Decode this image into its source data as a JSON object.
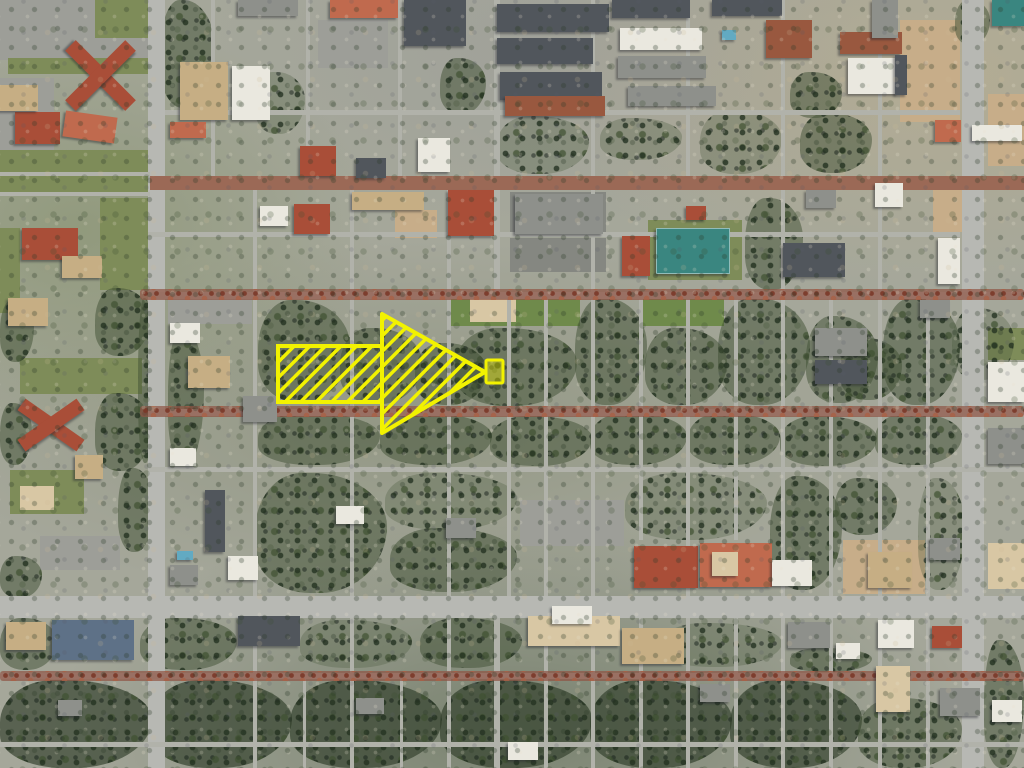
{
  "scene": {
    "palette": {
      "lawn": "#7e8c59",
      "lawn_bright": "#6f8a4b",
      "dirt": "#c7ad89",
      "dirt_light": "#d8c7a4",
      "parking": "#9d9e98",
      "parking_dark": "#858781",
      "road": "#b1b2aa",
      "road_major": "#b7b8b3",
      "brick_road": "#9b6956",
      "roof_red": "#a94e38",
      "roof_red_light": "#c06a4e",
      "roof_tan": "#c6ae84",
      "roof_white": "#eae8df",
      "roof_gray": "#8e908b",
      "roof_slate": "#51565c",
      "roof_blue": "#5e7187",
      "roof_brick": "#99583f",
      "court_teal": "#3a8680",
      "pool_blue": "#62aac2",
      "annotation_yellow": "#f2f200"
    },
    "areas": [
      [
        0,
        0,
        148,
        60,
        "parking"
      ],
      [
        95,
        0,
        53,
        38,
        "lawn"
      ],
      [
        8,
        58,
        140,
        16,
        "lawn"
      ],
      [
        0,
        78,
        54,
        76,
        "parking"
      ],
      [
        318,
        20,
        70,
        48,
        "parking"
      ],
      [
        0,
        150,
        150,
        44,
        "lawn"
      ],
      [
        100,
        198,
        48,
        92,
        "lawn"
      ],
      [
        0,
        228,
        20,
        85,
        "lawn"
      ],
      [
        20,
        358,
        122,
        36,
        "lawn"
      ],
      [
        10,
        470,
        74,
        44,
        "lawn"
      ],
      [
        20,
        486,
        34,
        24,
        "dirt_light"
      ],
      [
        40,
        536,
        80,
        34,
        "parking"
      ],
      [
        168,
        296,
        84,
        28,
        "parking"
      ],
      [
        395,
        210,
        42,
        28,
        "dirt"
      ],
      [
        510,
        192,
        96,
        44,
        "parking_dark"
      ],
      [
        510,
        238,
        96,
        34,
        "parking_dark"
      ],
      [
        648,
        220,
        94,
        60,
        "lawn"
      ],
      [
        900,
        20,
        60,
        102,
        "dirt"
      ],
      [
        933,
        180,
        40,
        52,
        "dirt"
      ],
      [
        988,
        94,
        36,
        72,
        "dirt"
      ],
      [
        448,
        296,
        132,
        30,
        "lawn_bright"
      ],
      [
        640,
        294,
        84,
        32,
        "lawn_bright"
      ],
      [
        520,
        500,
        104,
        46,
        "parking"
      ],
      [
        843,
        540,
        82,
        54,
        "dirt"
      ],
      [
        988,
        543,
        36,
        46,
        "dirt_light"
      ],
      [
        988,
        328,
        36,
        32,
        "lawn"
      ],
      [
        470,
        298,
        46,
        24,
        "dirt_light"
      ]
    ],
    "trees": [
      [
        160,
        0,
        55,
        108,
        1
      ],
      [
        255,
        72,
        50,
        62,
        0
      ],
      [
        440,
        58,
        46,
        56,
        1
      ],
      [
        600,
        118,
        82,
        42,
        0
      ],
      [
        790,
        72,
        52,
        46,
        1
      ],
      [
        497,
        116,
        92,
        58,
        0
      ],
      [
        700,
        110,
        82,
        64,
        0
      ],
      [
        800,
        113,
        72,
        60,
        1
      ],
      [
        955,
        0,
        35,
        45,
        1
      ],
      [
        95,
        288,
        55,
        68,
        1
      ],
      [
        0,
        300,
        34,
        62,
        1
      ],
      [
        138,
        298,
        16,
        165,
        1
      ],
      [
        168,
        328,
        36,
        138,
        1
      ],
      [
        0,
        403,
        32,
        62,
        1
      ],
      [
        95,
        393,
        56,
        78,
        1
      ],
      [
        118,
        468,
        36,
        84,
        1
      ],
      [
        0,
        556,
        42,
        42,
        1
      ],
      [
        745,
        198,
        58,
        92,
        1
      ],
      [
        840,
        338,
        62,
        62,
        1
      ],
      [
        258,
        300,
        92,
        102,
        1
      ],
      [
        340,
        328,
        82,
        76,
        1
      ],
      [
        415,
        343,
        72,
        62,
        1
      ],
      [
        455,
        328,
        122,
        78,
        1
      ],
      [
        575,
        298,
        72,
        107,
        1
      ],
      [
        645,
        328,
        82,
        77,
        1
      ],
      [
        718,
        298,
        92,
        107,
        1
      ],
      [
        806,
        316,
        72,
        87,
        1
      ],
      [
        883,
        298,
        77,
        107,
        1
      ],
      [
        952,
        308,
        62,
        72,
        0
      ],
      [
        258,
        413,
        122,
        52,
        1
      ],
      [
        380,
        413,
        112,
        52,
        1
      ],
      [
        490,
        416,
        102,
        50,
        1
      ],
      [
        590,
        413,
        97,
        52,
        1
      ],
      [
        688,
        413,
        92,
        52,
        1
      ],
      [
        780,
        416,
        97,
        50,
        1
      ],
      [
        875,
        413,
        87,
        52,
        1
      ],
      [
        255,
        473,
        132,
        120,
        1
      ],
      [
        385,
        473,
        132,
        57,
        0
      ],
      [
        390,
        528,
        127,
        64,
        1
      ],
      [
        625,
        473,
        142,
        67,
        0
      ],
      [
        770,
        476,
        72,
        114,
        1
      ],
      [
        835,
        478,
        62,
        57,
        1
      ],
      [
        918,
        478,
        47,
        112,
        0
      ],
      [
        0,
        618,
        57,
        52,
        1
      ],
      [
        140,
        618,
        97,
        52,
        1
      ],
      [
        300,
        620,
        112,
        48,
        0
      ],
      [
        420,
        618,
        102,
        50,
        1
      ],
      [
        660,
        623,
        122,
        44,
        0
      ],
      [
        790,
        648,
        82,
        24,
        1
      ],
      [
        0,
        680,
        152,
        88,
        2
      ],
      [
        150,
        680,
        142,
        88,
        2
      ],
      [
        290,
        680,
        152,
        88,
        2
      ],
      [
        440,
        680,
        152,
        88,
        2
      ],
      [
        590,
        680,
        142,
        88,
        2
      ],
      [
        730,
        680,
        132,
        88,
        2
      ],
      [
        858,
        698,
        104,
        70,
        1
      ],
      [
        984,
        640,
        40,
        128,
        1
      ]
    ],
    "roads": [
      [
        148,
        0,
        17,
        768,
        "road_major",
        "v"
      ],
      [
        962,
        0,
        22,
        768,
        "road_major",
        "v"
      ],
      [
        211,
        0,
        4,
        180,
        "road"
      ],
      [
        306,
        0,
        4,
        180,
        "road"
      ],
      [
        398,
        0,
        4,
        180,
        "road"
      ],
      [
        253,
        180,
        4,
        588,
        "road"
      ],
      [
        350,
        180,
        4,
        588,
        "road"
      ],
      [
        447,
        180,
        4,
        588,
        "road"
      ],
      [
        494,
        0,
        6,
        295,
        "road"
      ],
      [
        507,
        295,
        4,
        305,
        "road"
      ],
      [
        494,
        600,
        6,
        168,
        "road"
      ],
      [
        544,
        295,
        4,
        473,
        "road"
      ],
      [
        591,
        0,
        4,
        768,
        "road"
      ],
      [
        639,
        295,
        4,
        245,
        "road"
      ],
      [
        639,
        600,
        4,
        168,
        "road"
      ],
      [
        686,
        0,
        4,
        185,
        "road"
      ],
      [
        686,
        295,
        4,
        473,
        "road"
      ],
      [
        734,
        295,
        4,
        245,
        "road"
      ],
      [
        734,
        600,
        4,
        168,
        "road"
      ],
      [
        781,
        0,
        4,
        768,
        "road"
      ],
      [
        829,
        295,
        4,
        473,
        "road"
      ],
      [
        878,
        0,
        4,
        768,
        "road"
      ],
      [
        926,
        295,
        4,
        473,
        "road"
      ],
      [
        303,
        676,
        3,
        92,
        "road"
      ],
      [
        400,
        676,
        3,
        92,
        "road"
      ],
      [
        150,
        176,
        874,
        14,
        "brick_road"
      ],
      [
        0,
        172,
        150,
        4,
        "road"
      ],
      [
        0,
        192,
        150,
        4,
        "road"
      ],
      [
        165,
        110,
        795,
        5,
        "road"
      ],
      [
        148,
        232,
        812,
        5,
        "road"
      ],
      [
        148,
        292,
        876,
        7,
        "road"
      ],
      [
        148,
        409,
        876,
        7,
        "road"
      ],
      [
        148,
        467,
        876,
        5,
        "road"
      ],
      [
        0,
        596,
        1024,
        22,
        "road_major",
        "h"
      ],
      [
        0,
        673,
        1024,
        6,
        "road"
      ],
      [
        0,
        742,
        1024,
        5,
        "road"
      ]
    ],
    "tree_streets": [
      [
        140,
        289,
        884,
        11
      ],
      [
        140,
        406,
        884,
        11
      ],
      [
        0,
        671,
        1024,
        10
      ]
    ],
    "buildings": [
      [
        58,
        68,
        85,
        15,
        "roof_red",
        45
      ],
      [
        58,
        68,
        85,
        15,
        "roof_red",
        -45
      ],
      [
        15,
        112,
        45,
        32,
        "roof_red",
        0
      ],
      [
        64,
        114,
        52,
        26,
        "roof_red_light",
        8
      ],
      [
        0,
        85,
        38,
        26,
        "roof_tan",
        0
      ],
      [
        22,
        228,
        56,
        32,
        "roof_red",
        0
      ],
      [
        8,
        298,
        40,
        28,
        "roof_tan",
        0
      ],
      [
        62,
        256,
        40,
        22,
        "roof_tan",
        0
      ],
      [
        15,
        418,
        72,
        14,
        "roof_red",
        35
      ],
      [
        15,
        418,
        72,
        14,
        "roof_red",
        -35
      ],
      [
        75,
        455,
        28,
        24,
        "roof_tan",
        0
      ],
      [
        180,
        62,
        48,
        58,
        "roof_tan",
        0
      ],
      [
        232,
        66,
        38,
        54,
        "roof_white",
        0
      ],
      [
        170,
        122,
        36,
        16,
        "roof_red_light",
        0
      ],
      [
        300,
        146,
        36,
        30,
        "roof_red",
        0
      ],
      [
        356,
        158,
        30,
        20,
        "roof_slate",
        0
      ],
      [
        418,
        138,
        32,
        34,
        "roof_white",
        0
      ],
      [
        330,
        0,
        68,
        18,
        "roof_red_light",
        0
      ],
      [
        404,
        0,
        62,
        46,
        "roof_slate",
        0,
        "st"
      ],
      [
        238,
        0,
        60,
        16,
        "roof_gray",
        0
      ],
      [
        497,
        4,
        112,
        28,
        "roof_slate",
        0,
        "st"
      ],
      [
        497,
        38,
        96,
        26,
        "roof_slate",
        0,
        "st"
      ],
      [
        500,
        72,
        102,
        28,
        "roof_slate",
        0,
        "st"
      ],
      [
        505,
        96,
        100,
        20,
        "roof_brick",
        0
      ],
      [
        612,
        0,
        78,
        18,
        "roof_slate",
        0,
        "st"
      ],
      [
        620,
        28,
        82,
        22,
        "roof_white",
        0,
        "st"
      ],
      [
        618,
        56,
        88,
        22,
        "roof_gray",
        0,
        "st"
      ],
      [
        628,
        86,
        88,
        20,
        "roof_gray",
        0
      ],
      [
        712,
        0,
        70,
        16,
        "roof_slate",
        0
      ],
      [
        766,
        20,
        46,
        38,
        "roof_brick",
        0
      ],
      [
        722,
        30,
        14,
        10,
        "pool_blue",
        0
      ],
      [
        840,
        32,
        62,
        22,
        "roof_brick",
        0
      ],
      [
        848,
        58,
        50,
        36,
        "roof_white",
        0
      ],
      [
        895,
        55,
        12,
        40,
        "roof_slate",
        0
      ],
      [
        992,
        0,
        32,
        26,
        "court_teal",
        0
      ],
      [
        935,
        120,
        26,
        22,
        "roof_red_light",
        0
      ],
      [
        972,
        125,
        50,
        16,
        "roof_white",
        0
      ],
      [
        872,
        0,
        26,
        38,
        "roof_gray",
        0
      ],
      [
        294,
        204,
        36,
        30,
        "roof_red",
        0
      ],
      [
        260,
        206,
        28,
        20,
        "roof_white",
        0
      ],
      [
        352,
        192,
        72,
        18,
        "roof_tan",
        0
      ],
      [
        448,
        190,
        46,
        46,
        "roof_red",
        0
      ],
      [
        515,
        194,
        88,
        40,
        "roof_gray",
        0,
        "st"
      ],
      [
        622,
        236,
        28,
        40,
        "roof_red",
        0
      ],
      [
        656,
        228,
        72,
        44,
        "court_teal",
        0,
        "court"
      ],
      [
        686,
        206,
        20,
        14,
        "roof_red",
        0
      ],
      [
        875,
        183,
        28,
        24,
        "roof_white",
        0
      ],
      [
        783,
        243,
        62,
        34,
        "roof_slate",
        0,
        "st"
      ],
      [
        938,
        238,
        22,
        46,
        "roof_white",
        0
      ],
      [
        806,
        190,
        30,
        18,
        "roof_gray",
        0
      ],
      [
        188,
        356,
        42,
        32,
        "roof_tan",
        0
      ],
      [
        170,
        323,
        30,
        20,
        "roof_white",
        0
      ],
      [
        243,
        396,
        34,
        26,
        "roof_gray",
        0
      ],
      [
        205,
        490,
        20,
        62,
        "roof_slate",
        0
      ],
      [
        177,
        551,
        16,
        9,
        "pool_blue",
        0
      ],
      [
        170,
        448,
        26,
        18,
        "roof_white",
        0
      ],
      [
        228,
        556,
        30,
        24,
        "roof_white",
        0
      ],
      [
        170,
        565,
        28,
        20,
        "roof_gray",
        0
      ],
      [
        815,
        328,
        52,
        28,
        "roof_gray",
        0
      ],
      [
        815,
        360,
        52,
        24,
        "roof_slate",
        0
      ],
      [
        988,
        362,
        36,
        40,
        "roof_white",
        0
      ],
      [
        920,
        300,
        30,
        18,
        "roof_gray",
        0
      ],
      [
        634,
        546,
        64,
        42,
        "roof_red",
        0
      ],
      [
        700,
        543,
        72,
        44,
        "roof_red_light",
        0
      ],
      [
        712,
        552,
        26,
        24,
        "dirt_light",
        0
      ],
      [
        772,
        560,
        40,
        26,
        "roof_white",
        0
      ],
      [
        868,
        552,
        44,
        36,
        "roof_tan",
        0
      ],
      [
        930,
        538,
        30,
        22,
        "roof_gray",
        0
      ],
      [
        446,
        518,
        30,
        20,
        "roof_gray",
        0
      ],
      [
        336,
        506,
        28,
        18,
        "roof_white",
        0
      ],
      [
        52,
        620,
        82,
        40,
        "roof_blue",
        0,
        "st"
      ],
      [
        6,
        622,
        40,
        28,
        "roof_tan",
        0
      ],
      [
        238,
        616,
        62,
        30,
        "roof_slate",
        0
      ],
      [
        528,
        616,
        92,
        30,
        "dirt_light",
        0
      ],
      [
        552,
        606,
        40,
        18,
        "roof_white",
        0
      ],
      [
        622,
        628,
        62,
        36,
        "roof_tan",
        0
      ],
      [
        788,
        622,
        42,
        26,
        "roof_gray",
        0
      ],
      [
        878,
        620,
        36,
        28,
        "roof_white",
        0
      ],
      [
        932,
        626,
        30,
        22,
        "roof_red",
        0
      ],
      [
        836,
        643,
        24,
        16,
        "roof_white",
        0
      ],
      [
        876,
        666,
        34,
        46,
        "dirt_light",
        0
      ],
      [
        940,
        688,
        40,
        28,
        "roof_gray",
        0
      ],
      [
        356,
        698,
        28,
        16,
        "roof_gray",
        0
      ],
      [
        700,
        684,
        30,
        18,
        "roof_gray",
        0
      ],
      [
        58,
        700,
        24,
        16,
        "roof_gray",
        0
      ],
      [
        508,
        742,
        30,
        18,
        "roof_white",
        0
      ],
      [
        988,
        428,
        36,
        36,
        "roof_gray",
        0
      ],
      [
        992,
        700,
        30,
        22,
        "roof_white",
        0
      ]
    ],
    "annotation": {
      "arrow": {
        "color": "#f2f200",
        "stroke_width": 4,
        "hatch_gap": 11,
        "hatch_line": 3.5,
        "shaft": {
          "x": 278,
          "y": 346,
          "w": 104,
          "h": 56
        },
        "head_points": "382,314 382,433 485,372"
      },
      "marker": {
        "x": 486,
        "y": 360,
        "w": 17,
        "h": 23,
        "fill": "rgba(242,242,0,0.40)",
        "stroke_width": 3
      }
    }
  }
}
